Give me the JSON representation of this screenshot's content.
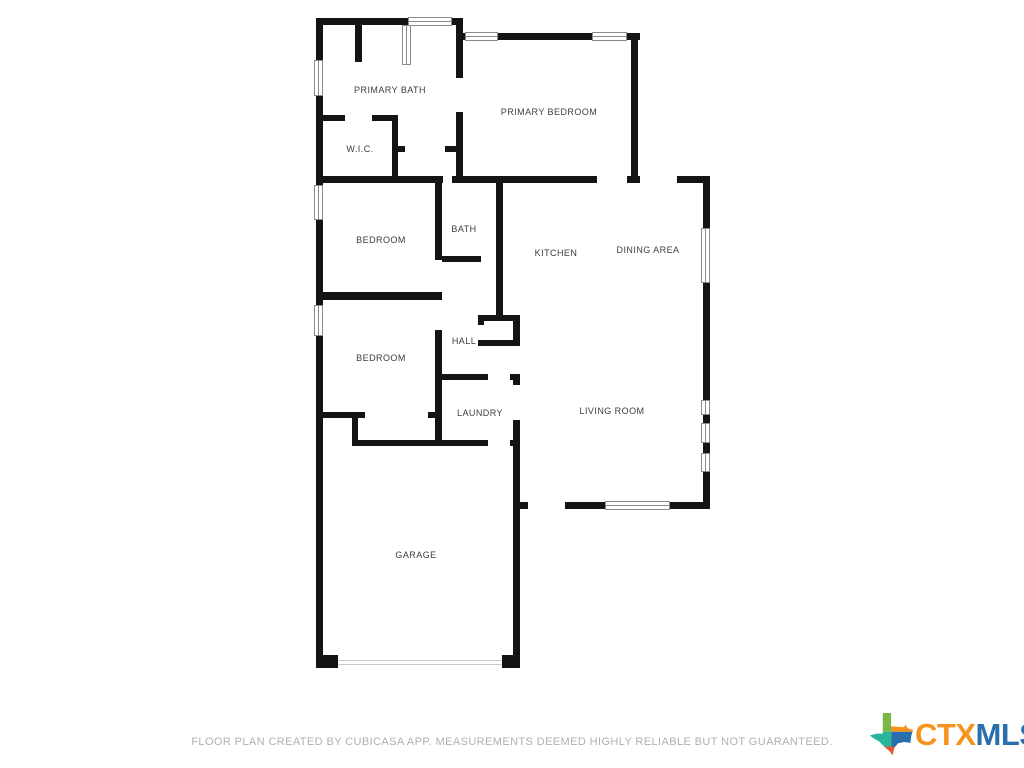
{
  "floor_plan": {
    "rooms": [
      {
        "label": "PRIMARY BATH"
      },
      {
        "label": "W.I.C."
      },
      {
        "label": "PRIMARY BEDROOM"
      },
      {
        "label": "BEDROOM"
      },
      {
        "label": "BATH"
      },
      {
        "label": "KITCHEN"
      },
      {
        "label": "DINING AREA"
      },
      {
        "label": "BEDROOM"
      },
      {
        "label": "HALL"
      },
      {
        "label": "LAUNDRY"
      },
      {
        "label": "LIVING ROOM"
      },
      {
        "label": "GARAGE"
      }
    ]
  },
  "footer": {
    "disclaimer": "FLOOR PLAN CREATED BY CUBICASA APP. MEASUREMENTS DEEMED HIGHLY RELIABLE BUT NOT GUARANTEED."
  },
  "logo": {
    "ctx": "CTX",
    "mls": "MLS",
    "icon": "texas-state-icon",
    "colors": {
      "ctx_orange": "#F6921E",
      "mls_blue": "#2A6FAD",
      "texas_green": "#7AB648",
      "texas_orange": "#F6921E",
      "texas_teal": "#29B59C",
      "texas_blue": "#2A6FAD",
      "texas_red": "#E8542F"
    }
  },
  "colors": {
    "wall": "#141414",
    "background": "#FFFFFF",
    "room_label": "#3D3D3D",
    "footer_text": "#B0B0B0"
  }
}
